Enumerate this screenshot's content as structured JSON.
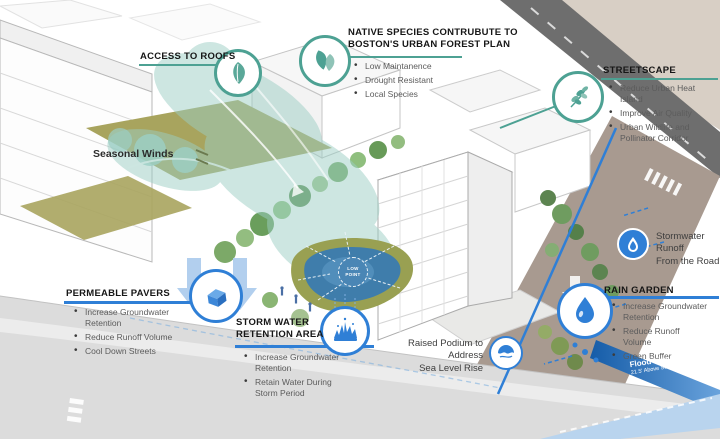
{
  "colors": {
    "teal_accent": "#4da193",
    "blue_accent": "#2f7fd6",
    "olive_roof": "#a8a45e",
    "pond_blue": "#3f7dab",
    "flood_dark_blue": "#155ca8",
    "flood_light_blue": "#b9d4ee",
    "road_taupe": "#a89a90"
  },
  "icons": {
    "access_to_roofs": "leaf-icon",
    "native_species": "double-leaf-icon",
    "streetscape": "branch-leaves-icon",
    "permeable_pavers": "paver-brick-icon",
    "storm_water_retention": "water-splash-icon",
    "stormwater_runoff": "droplet-icon",
    "rain_garden": "water-drop-icon",
    "raised_podium": "sea-level-wave-icon"
  },
  "callouts": {
    "access_to_roofs": {
      "title": "ACCESS TO ROOFS"
    },
    "native_species": {
      "title_line1": "NATIVE SPECIES CONTRUBUTE TO",
      "title_line2": "BOSTON'S URBAN FOREST PLAN",
      "bullets": [
        "Low Maintanence",
        "Drought Resistant",
        "Local Species"
      ]
    },
    "streetscape": {
      "title": "STREETSCAPE",
      "bullets": [
        "Reduce Urban Heat Island",
        "Improve Air Quality",
        "Urban Wildlife and Pollinator Corridor"
      ]
    },
    "permeable_pavers": {
      "title": "PERMEABLE PAVERS",
      "bullets": [
        "Increase Groundwater Retention",
        "Reduce Runoff Volume",
        "Cool Down Streets"
      ]
    },
    "storm_water_retention": {
      "title_line1": "STORM WATER",
      "title_line2": "RETENTION AREA",
      "bullets": [
        "Increase Groundwater Retention",
        "Retain Water During Storm Period"
      ]
    },
    "rain_garden": {
      "title": "RAIN GARDEN",
      "bullets": [
        "Increase Groundwater Retention",
        "Reduce Runoff Volume",
        "Green Buffer"
      ]
    },
    "stormwater_runoff": {
      "line1": "Stormwater Runoff",
      "line2": "From the Road"
    },
    "raised_podium": {
      "line1": "Raised Podium to Address",
      "line2": "Sea Level Rise"
    },
    "seasonal_winds": {
      "label": "Seasonal Winds"
    },
    "flood_line": {
      "title": "Flood Line",
      "subtitle": "21.5' Above Sea Level"
    },
    "low_point": {
      "label": "LOW POINT"
    }
  }
}
